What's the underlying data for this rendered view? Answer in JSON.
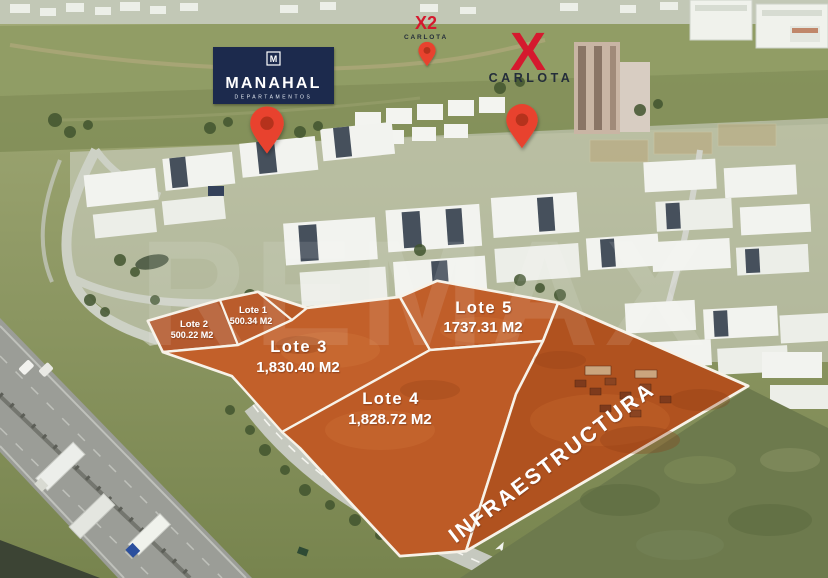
{
  "watermark": "REMAX",
  "infrastructure": {
    "label": "INFRAESTRUCTURA"
  },
  "lots": [
    {
      "id": "lote-1",
      "label": "Lote 1",
      "area": "500.34 M2"
    },
    {
      "id": "lote-2",
      "label": "Lote 2",
      "area": "500.22 M2"
    },
    {
      "id": "lote-3",
      "label": "Lote 3",
      "area": "1,830.40 M2"
    },
    {
      "id": "lote-4",
      "label": "Lote 4",
      "area": "1,828.72 M2"
    },
    {
      "id": "lote-5",
      "label": "Lote 5",
      "area": "1737.31 M2"
    }
  ],
  "logos": {
    "manahal": {
      "monogram": "M",
      "name": "MANAHAL",
      "subtitle": "DEPARTAMENTOS",
      "bg_color": "#1c2b4e",
      "text_color": "#ffffff"
    },
    "carlota_x2": {
      "mark": "X2",
      "name": "CARLOTA",
      "accent_color": "#d5192e",
      "text_color": "#242d3a"
    },
    "carlota_main": {
      "mark": "X",
      "name": "CARLOTA",
      "accent_color": "#d5192e",
      "text_color": "#242d3a"
    }
  },
  "colors": {
    "pin_red": "#e8432e",
    "pin_hole": "#b5301c",
    "lot_boundary": "#f7f2e8",
    "lot_fill": "#bd5b26",
    "label_text": "#ffffff"
  }
}
